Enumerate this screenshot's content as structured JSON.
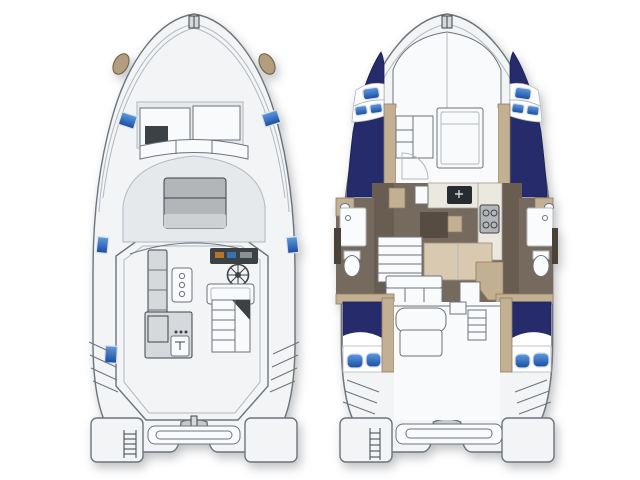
{
  "palette": {
    "bg": "#ffffff",
    "line_dark": "#3f4347",
    "line_mid": "#6d747a",
    "line_light": "#b3b9be",
    "deck_white": "#f2f4f6",
    "deck_mid": "#e6e9ec",
    "white_soft": "#f9fafb",
    "furniture_gray": "#d6d9dc",
    "sunpad": "#b2b6b9",
    "sunpad_light": "#cdd1d4",
    "navy": "#252b6b",
    "navy_dark": "#181d50",
    "hatch_light": "#5d9ce2",
    "hatch_dark": "#1b4b9e",
    "hatch_frame": "#dce2e8",
    "tan": "#c3b092",
    "tan_dark": "#8f7d5f",
    "pad_tan": "#b29e7e",
    "pad_tan_dark": "#6a5a41",
    "floor_brown": "#76695e",
    "floor_brown_dark": "#695d52",
    "cream": "#ebe9df",
    "cream_dark": "#a4a296",
    "console_dark": "#3c4146",
    "fixture_dark": "#4a4138",
    "cushion_tan": "#d9c9b0",
    "cushion_tan_dark": "#a5947a",
    "toilet_white": "#fafbfc"
  },
  "icons": {
    "helm-wheel": "circle-with-spokes",
    "deck-hatch": "blue-gradient-rounded-rect",
    "cabin-window": "blue-gradient-pill",
    "swim-ladder": "rails-with-rungs",
    "transom-steps": "diagonal-tread-lines",
    "toilet": "white-oval-with-tank",
    "shower-drain": "small-circle",
    "galley-sink": "dark-rect-with-faucet",
    "galley-stove": "gray-rect-with-burner-circles",
    "anchor-windlass": "small-gray-fitting"
  }
}
